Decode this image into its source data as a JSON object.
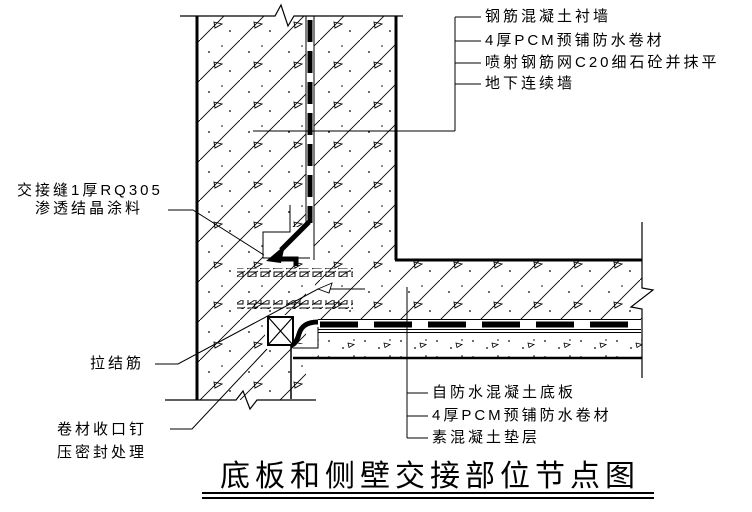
{
  "drawing": {
    "title": "底板和侧壁交接部位节点图",
    "wall_layer_callouts": [
      "钢筋混凝土衬墙",
      "4厚PCM预铺防水卷材",
      "喷射钢筋网C20细石砼并抹平",
      "地下连续墙"
    ],
    "left_callouts": {
      "joint_seam_line1": "交接缝1厚RQ305",
      "joint_seam_line2": "渗透结晶涂料",
      "tie_bar": "拉结筋",
      "membrane_seal_line1": "卷材收口钉",
      "membrane_seal_line2": "压密封处理"
    },
    "slab_layer_callouts": [
      "自防水混凝土底板",
      "4厚PCM预铺防水卷材",
      "素混凝土垫层"
    ],
    "colors": {
      "line": "#000000",
      "background": "#ffffff"
    }
  }
}
